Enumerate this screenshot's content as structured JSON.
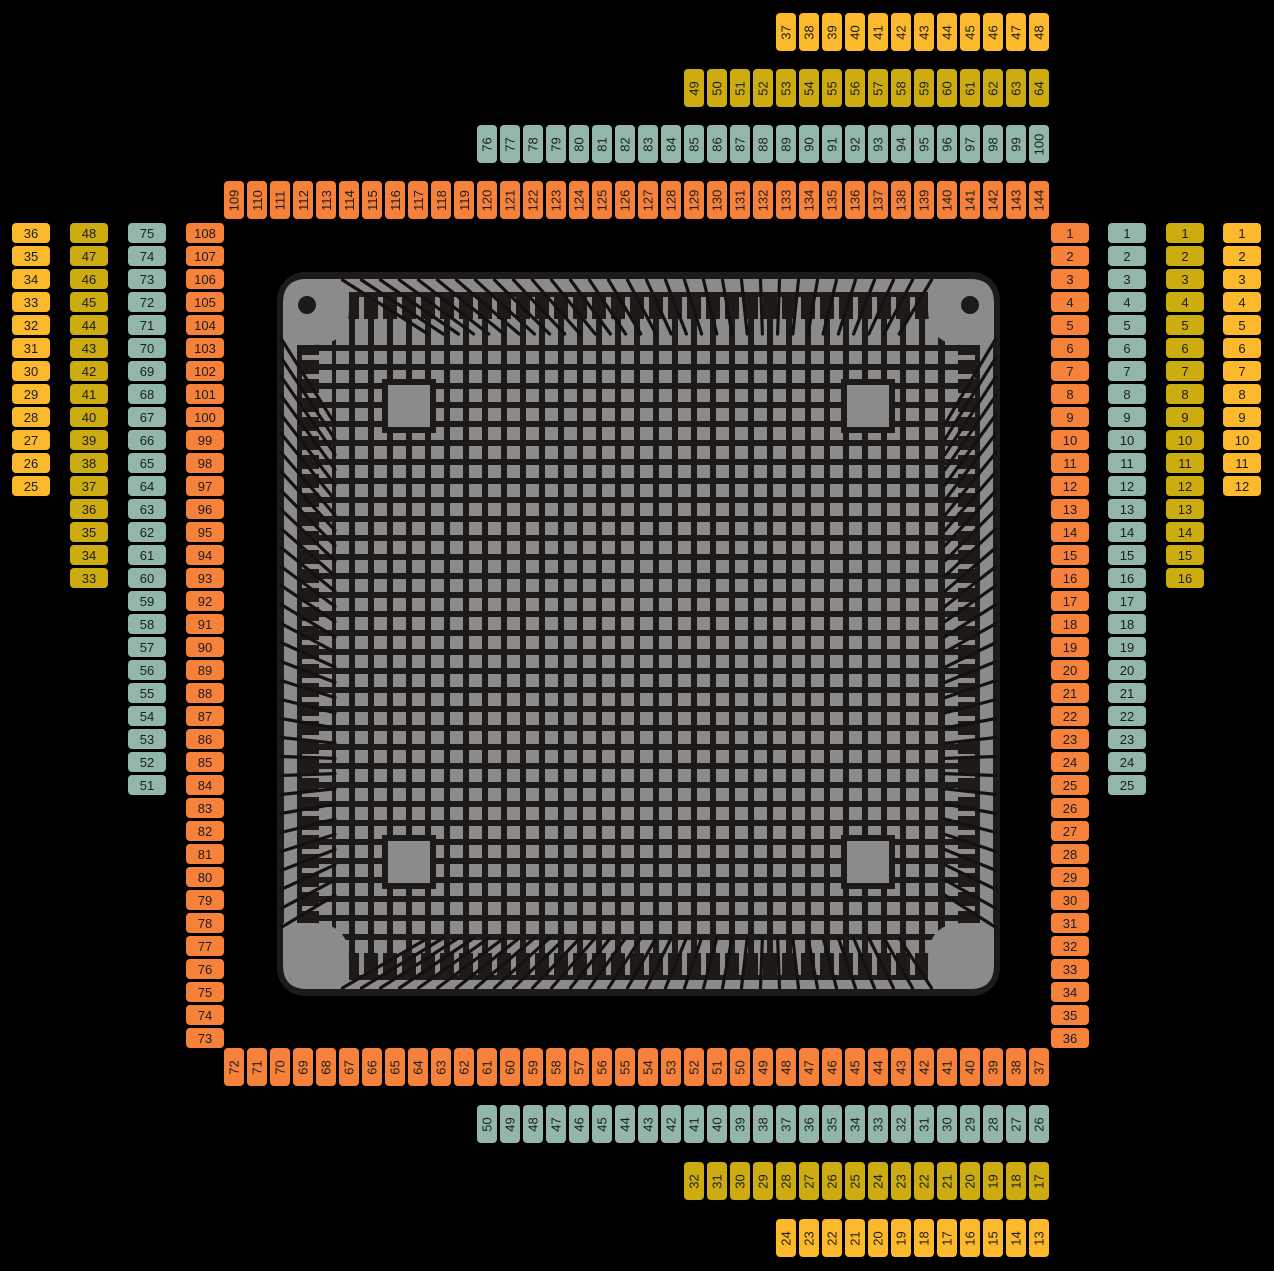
{
  "canvas": {
    "width": 1274,
    "height": 1271,
    "background": "#000000"
  },
  "label_text_color": "#1D1D1D",
  "rings": [
    {
      "id": "ring-144",
      "color": "#F6813B",
      "pins_total": 144,
      "sides": {
        "right": {
          "from": 1,
          "to": 36
        },
        "bottom": {
          "from": 72,
          "to": 37
        },
        "left": {
          "from": 108,
          "to": 73
        },
        "top": {
          "from": 109,
          "to": 144
        }
      }
    },
    {
      "id": "ring-100",
      "color": "#92B6AB",
      "pins_total": 100,
      "sides": {
        "right": {
          "from": 1,
          "to": 25
        },
        "bottom": {
          "from": 50,
          "to": 26
        },
        "left": {
          "from": 75,
          "to": 51
        },
        "top": {
          "from": 76,
          "to": 100
        }
      }
    },
    {
      "id": "ring-64",
      "color": "#CCAC10",
      "pins_total": 64,
      "sides": {
        "right": {
          "from": 1,
          "to": 16
        },
        "bottom": {
          "from": 32,
          "to": 17
        },
        "left": {
          "from": 48,
          "to": 33
        },
        "top": {
          "from": 49,
          "to": 64
        }
      }
    },
    {
      "id": "ring-48",
      "color": "#FDB92C",
      "pins_total": 48,
      "sides": {
        "right": {
          "from": 1,
          "to": 12
        },
        "bottom": {
          "from": 24,
          "to": 13
        },
        "left": {
          "from": 36,
          "to": 25
        },
        "top": {
          "from": 37,
          "to": 48
        }
      }
    }
  ],
  "chip": {
    "body_color": "#8B8B8B",
    "dark_color": "#1E1A18",
    "wire_color": "#151111",
    "pins_per_side": 32,
    "grid_cells": 32,
    "corner_marks": [
      "top-left",
      "top-right"
    ]
  }
}
